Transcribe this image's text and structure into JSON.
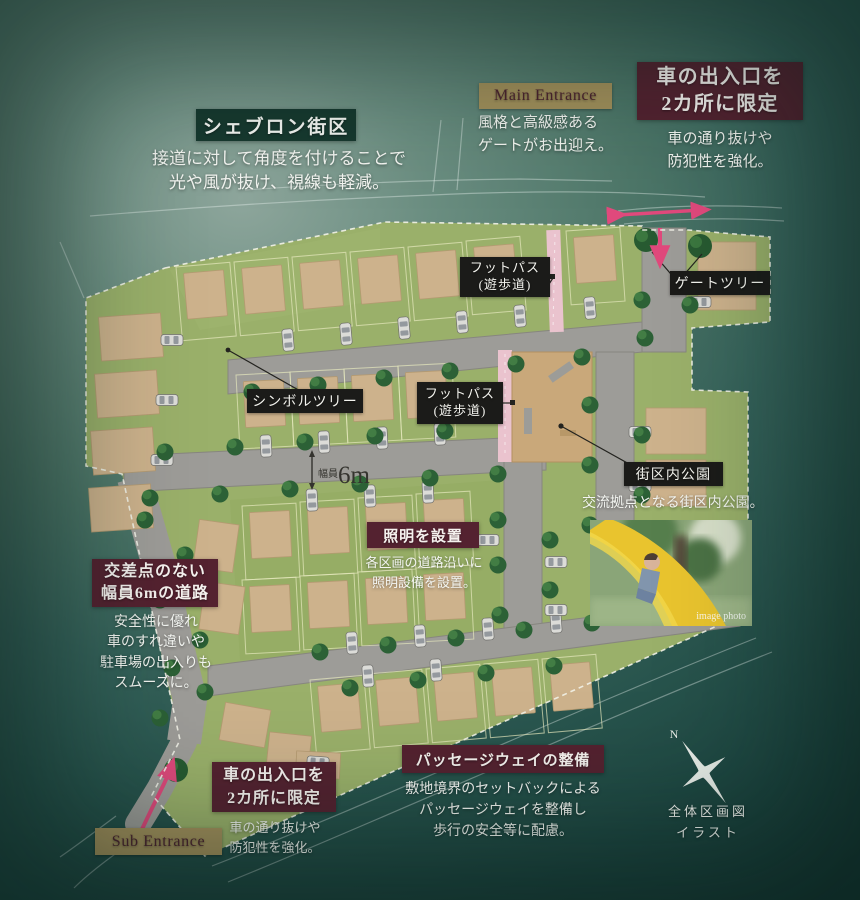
{
  "colors": {
    "background_teal": "#2f5a50",
    "callout_maroon": "#542230",
    "callout_dark_green": "#17392f",
    "map_label_black": "#1b1b19",
    "entrance_tan": "#a4915c",
    "accent_pink": "#e0497c",
    "lawn_green": "#9ab06a",
    "lot_tan": "#cdb28c",
    "road_gray": "#9d9c98"
  },
  "callouts": {
    "chevron_block": {
      "title": "シェブロン街区",
      "desc": "接道に対して角度を付けることで\n光や風が抜け、視線も軽減。"
    },
    "main_entrance": {
      "label": "Main Entrance",
      "desc": "風格と高級感ある\nゲートがお出迎え。"
    },
    "car_entrance_top": {
      "title": "車の出入口を\n2カ所に限定",
      "desc": "車の通り抜けや\n防犯性を強化。"
    },
    "car_entrance_bottom": {
      "title": "車の出入口を\n2カ所に限定",
      "desc": "車の通り抜けや\n防犯性を強化。"
    },
    "sub_entrance": {
      "label": "Sub Entrance"
    },
    "footpath_top": {
      "label": "フットパス\n(遊歩道)"
    },
    "footpath_mid": {
      "label": "フットパス\n(遊歩道)"
    },
    "gate_tree": {
      "label": "ゲートツリー"
    },
    "symbol_tree": {
      "label": "シンボルツリー"
    },
    "park": {
      "title": "街区内公園",
      "desc": "交流拠点となる街区内公園。",
      "photo_watermark": "image photo"
    },
    "lighting": {
      "title": "照明を設置",
      "desc": "各区画の道路沿いに\n照明設備を設置。"
    },
    "road_6m": {
      "title": "交差点のない\n幅員6mの道路",
      "desc": "安全性に優れ\n車のすれ違いや\n駐車場の出入りも\nスムーズに。"
    },
    "passageway": {
      "title": "パッセージウェイの整備",
      "desc": "敷地境界のセットバックによる\nパッセージウェイを整備し\n歩行の安全等に配慮。"
    }
  },
  "map": {
    "road_width_label": "幅員",
    "road_width_value": "6m",
    "compass_north": "N",
    "compass_caption": "全体区画図\nイラスト"
  }
}
